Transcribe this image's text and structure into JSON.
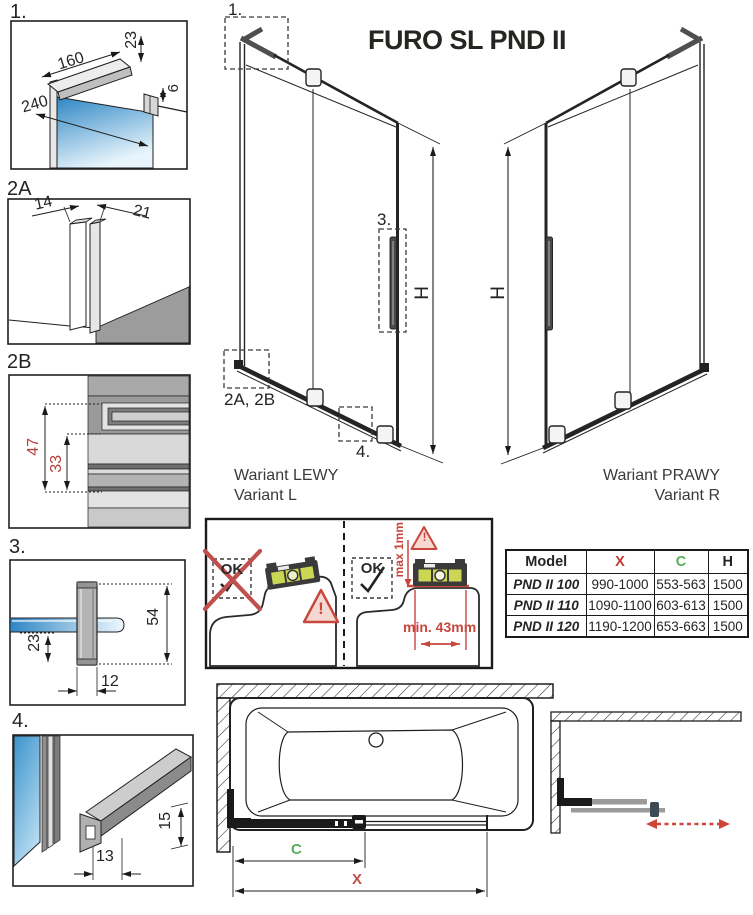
{
  "title": "FURO SL PND II",
  "details": {
    "d1": {
      "label": "1.",
      "dim_arm_length": "160",
      "dim_arm_height": "23",
      "dim_glass_width": "240",
      "dim_gap": "6"
    },
    "d2a": {
      "label": "2A",
      "dim_wall_side": "14",
      "dim_glass_side": "21"
    },
    "d2b": {
      "label": "2B",
      "dim_total": "47",
      "dim_inner": "33"
    },
    "d3": {
      "label": "3.",
      "dim_handle_length": "54",
      "dim_offset": "23",
      "dim_width": "12"
    },
    "d4": {
      "label": "4.",
      "dim_height": "15",
      "dim_width": "13"
    }
  },
  "elevation_left": {
    "marker_top": "1.",
    "marker_handle": "3.",
    "marker_bottom_left": "2A, 2B",
    "marker_bottom_rail": "4.",
    "height_label": "H",
    "caption_pl": "Wariant LEWY",
    "caption_en": "Variant L"
  },
  "elevation_right": {
    "height_label": "H",
    "caption_pl": "Wariant PRAWY",
    "caption_en": "Variant R"
  },
  "leveling": {
    "not_ok_label": "OK",
    "ok_label": "OK",
    "max_gap_label": "max 1mm",
    "min_distance_label": "min. 43mm",
    "warning_glyph": "!"
  },
  "spec_table": {
    "headers": {
      "model": "Model",
      "x": "X",
      "c": "C",
      "h": "H"
    },
    "rows": [
      {
        "model": "PND II 100",
        "x": "990-1000",
        "c": "553-563",
        "h": "1500"
      },
      {
        "model": "PND II 110",
        "x": "1090-1100",
        "c": "603-613",
        "h": "1500"
      },
      {
        "model": "PND II 120",
        "x": "1190-1200",
        "c": "653-663",
        "h": "1500"
      }
    ]
  },
  "plan": {
    "c_label": "C",
    "x_label": "X"
  },
  "colors": {
    "line": "#1a1a1a",
    "dim_red": "#b5413e",
    "warn_red": "#c9463d",
    "green": "#58ae58",
    "table_x_red": "#c0392b",
    "table_c_green": "#58ae58",
    "glass_blue": "#2e86c4",
    "arrow_red": "#d0453a"
  }
}
